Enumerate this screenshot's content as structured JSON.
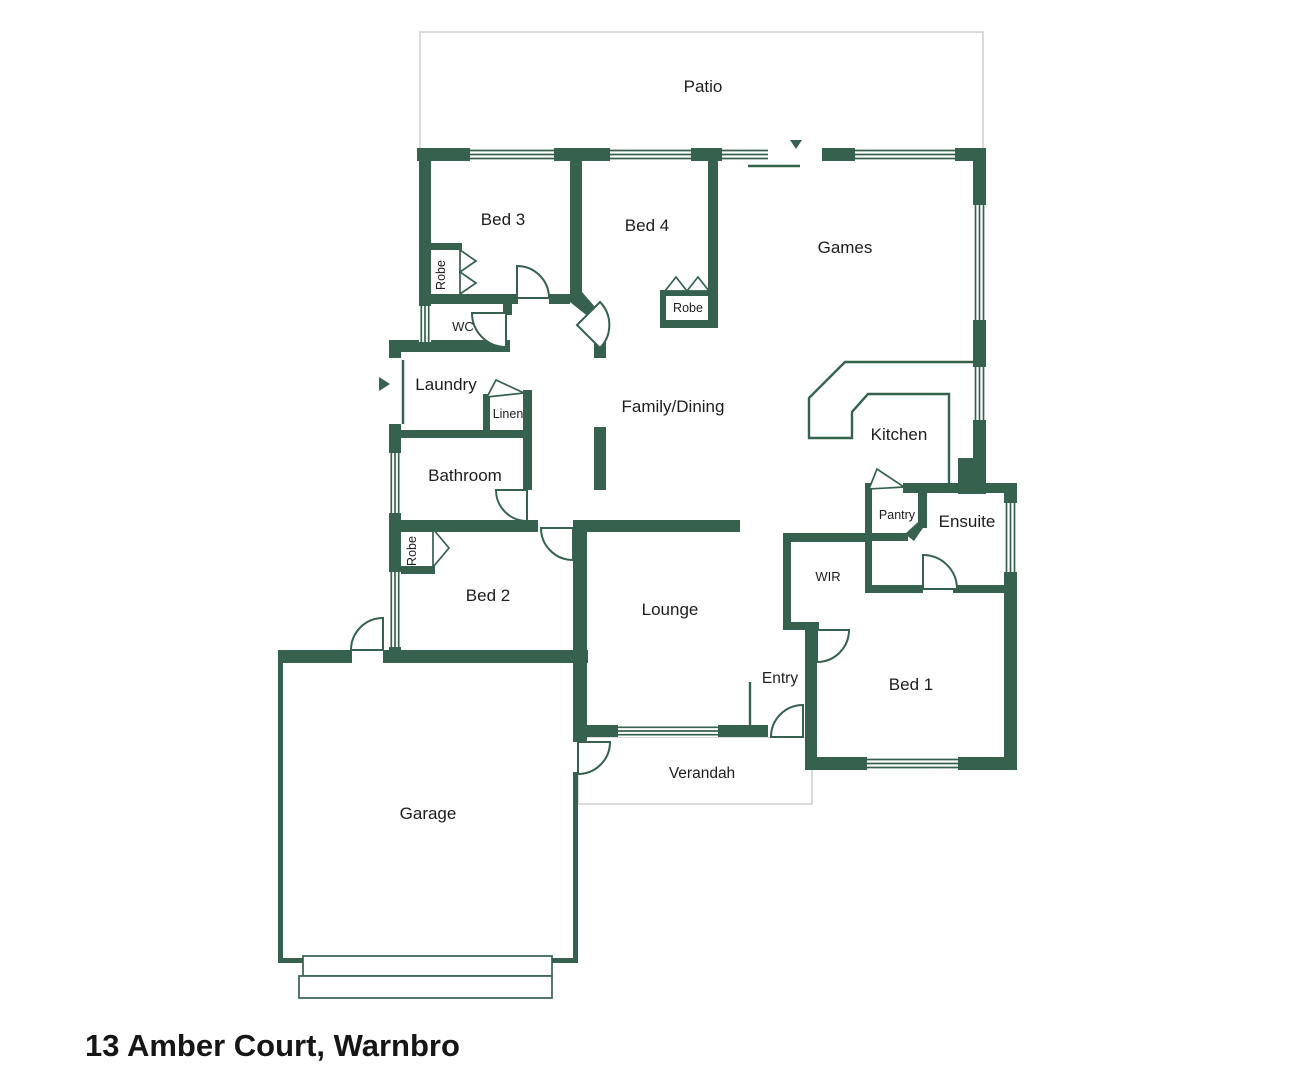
{
  "title": "13 Amber Court, Warnbro",
  "plan": {
    "colors": {
      "wall": "#36614F",
      "outdoor_outline": "#D6D6D6",
      "text": "#1d1d1d"
    },
    "rooms": [
      {
        "id": "patio",
        "label": "Patio"
      },
      {
        "id": "bed3",
        "label": "Bed 3"
      },
      {
        "id": "bed4",
        "label": "Bed 4"
      },
      {
        "id": "games",
        "label": "Games"
      },
      {
        "id": "robe-bed3",
        "label": "Robe"
      },
      {
        "id": "wc",
        "label": "WC"
      },
      {
        "id": "laundry",
        "label": "Laundry"
      },
      {
        "id": "linen",
        "label": "Linen"
      },
      {
        "id": "family",
        "label": "Family/Dining"
      },
      {
        "id": "kitchen",
        "label": "Kitchen"
      },
      {
        "id": "bathroom",
        "label": "Bathroom"
      },
      {
        "id": "robe-bed4",
        "label": "Robe"
      },
      {
        "id": "pantry",
        "label": "Pantry"
      },
      {
        "id": "ensuite",
        "label": "Ensuite"
      },
      {
        "id": "robe-bed2",
        "label": "Robe"
      },
      {
        "id": "wir",
        "label": "WIR"
      },
      {
        "id": "bed2",
        "label": "Bed 2"
      },
      {
        "id": "lounge",
        "label": "Lounge"
      },
      {
        "id": "entry",
        "label": "Entry"
      },
      {
        "id": "bed1",
        "label": "Bed 1"
      },
      {
        "id": "verandah",
        "label": "Verandah"
      },
      {
        "id": "garage",
        "label": "Garage"
      }
    ]
  }
}
